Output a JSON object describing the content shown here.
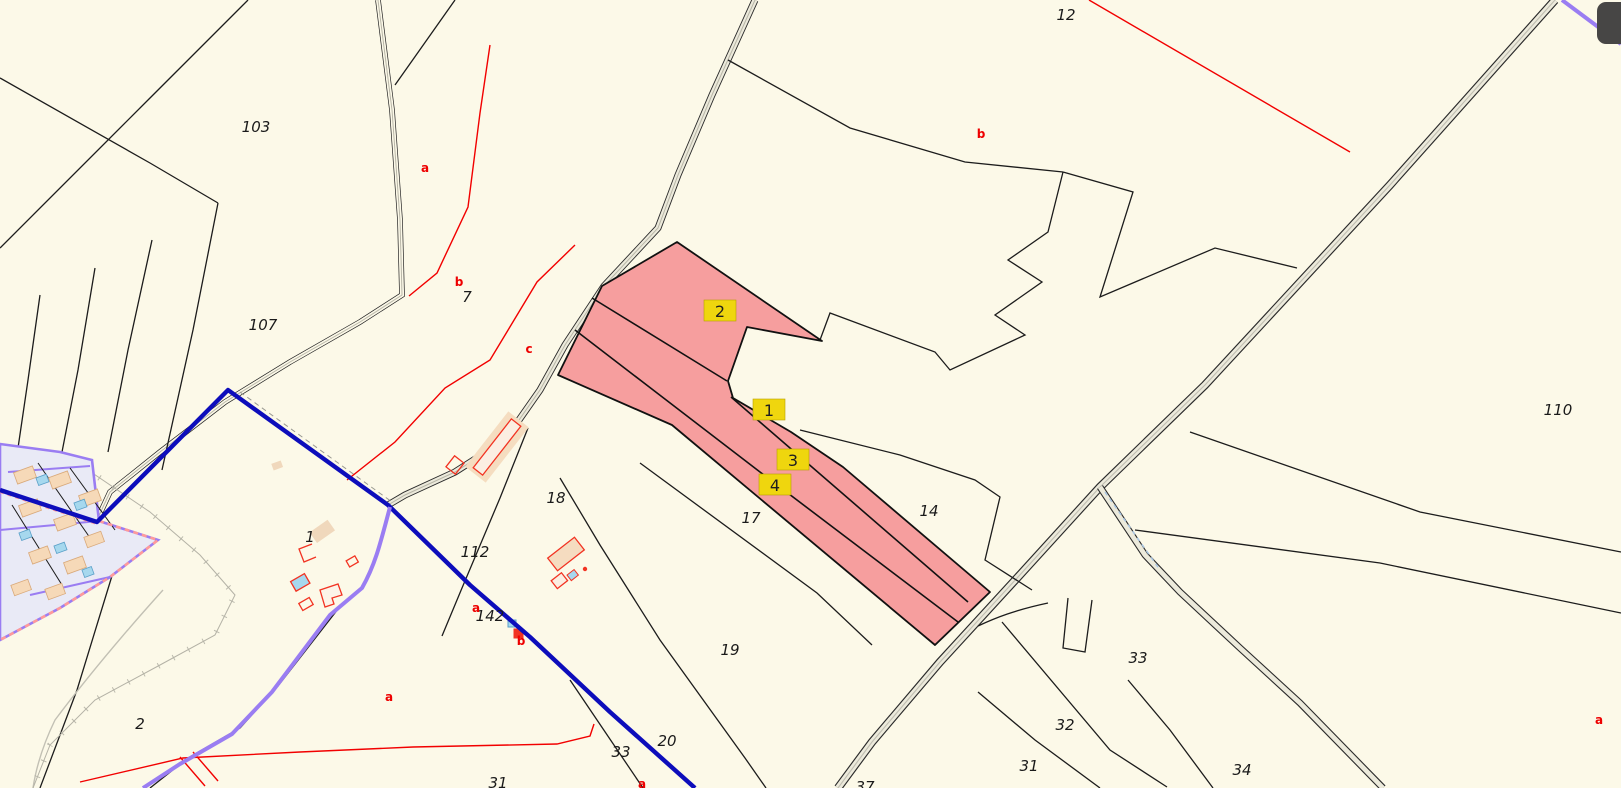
{
  "app": {
    "type": "cadastral-map-viewer"
  },
  "canvas": {
    "width": 1621,
    "height": 788,
    "background": "#fcf9e8"
  },
  "colors": {
    "parcel_line": "#1c1c1c",
    "selection_fill": "#f69e9e",
    "selection_border": "#111111",
    "marker_bg": "#efd60e",
    "marker_border": "#b89f00",
    "marker_text": "#1f1f1f",
    "red_line": "#f20000",
    "blue_boundary": "#0d0dbb",
    "purple_boundary": "#9a7df2",
    "village_fill": "#e9eaf6",
    "road_fill": "#eceadb",
    "building_fill": "#f6d9b8",
    "building_outline": "#f23322",
    "building_cyan": "#a6d8ee",
    "label_color": "#1a1a1a",
    "class_label_color": "#ee0000",
    "corner_button": "#474645"
  },
  "selection": {
    "markers": [
      {
        "label": "2",
        "x": 720,
        "y": 311
      },
      {
        "label": "1",
        "x": 769,
        "y": 410
      },
      {
        "label": "3",
        "x": 793,
        "y": 460
      },
      {
        "label": "4",
        "x": 775,
        "y": 485
      }
    ]
  },
  "parcel_labels": [
    {
      "text": "103",
      "x": 256,
      "y": 127
    },
    {
      "text": "107",
      "x": 263,
      "y": 325
    },
    {
      "text": "7",
      "x": 467,
      "y": 297
    },
    {
      "text": "12",
      "x": 1066,
      "y": 15
    },
    {
      "text": "110",
      "x": 1558,
      "y": 410
    },
    {
      "text": "14",
      "x": 929,
      "y": 511
    },
    {
      "text": "18",
      "x": 556,
      "y": 498
    },
    {
      "text": "17",
      "x": 751,
      "y": 518
    },
    {
      "text": "1",
      "x": 310,
      "y": 537
    },
    {
      "text": "112",
      "x": 475,
      "y": 552
    },
    {
      "text": "142",
      "x": 490,
      "y": 616
    },
    {
      "text": "19",
      "x": 730,
      "y": 650
    },
    {
      "text": "2",
      "x": 140,
      "y": 724
    },
    {
      "text": "33",
      "x": 621,
      "y": 752
    },
    {
      "text": "20",
      "x": 667,
      "y": 741
    },
    {
      "text": "31",
      "x": 498,
      "y": 783
    },
    {
      "text": "37",
      "x": 865,
      "y": 787
    },
    {
      "text": "33",
      "x": 1138,
      "y": 658
    },
    {
      "text": "32",
      "x": 1065,
      "y": 725
    },
    {
      "text": "31",
      "x": 1029,
      "y": 766
    },
    {
      "text": "34",
      "x": 1242,
      "y": 770
    }
  ],
  "class_labels": [
    {
      "text": "a",
      "x": 425,
      "y": 168
    },
    {
      "text": "b",
      "x": 459,
      "y": 282
    },
    {
      "text": "c",
      "x": 529,
      "y": 349
    },
    {
      "text": "b",
      "x": 981,
      "y": 134
    },
    {
      "text": "a",
      "x": 476,
      "y": 608
    },
    {
      "text": "a",
      "x": 389,
      "y": 697
    },
    {
      "text": "b",
      "x": 521,
      "y": 641,
      "size": 11
    },
    {
      "text": "a",
      "x": 642,
      "y": 784
    },
    {
      "text": "a",
      "x": 1599,
      "y": 720
    }
  ],
  "ui": {
    "corner_button": {
      "name": "map-tool-button"
    }
  }
}
